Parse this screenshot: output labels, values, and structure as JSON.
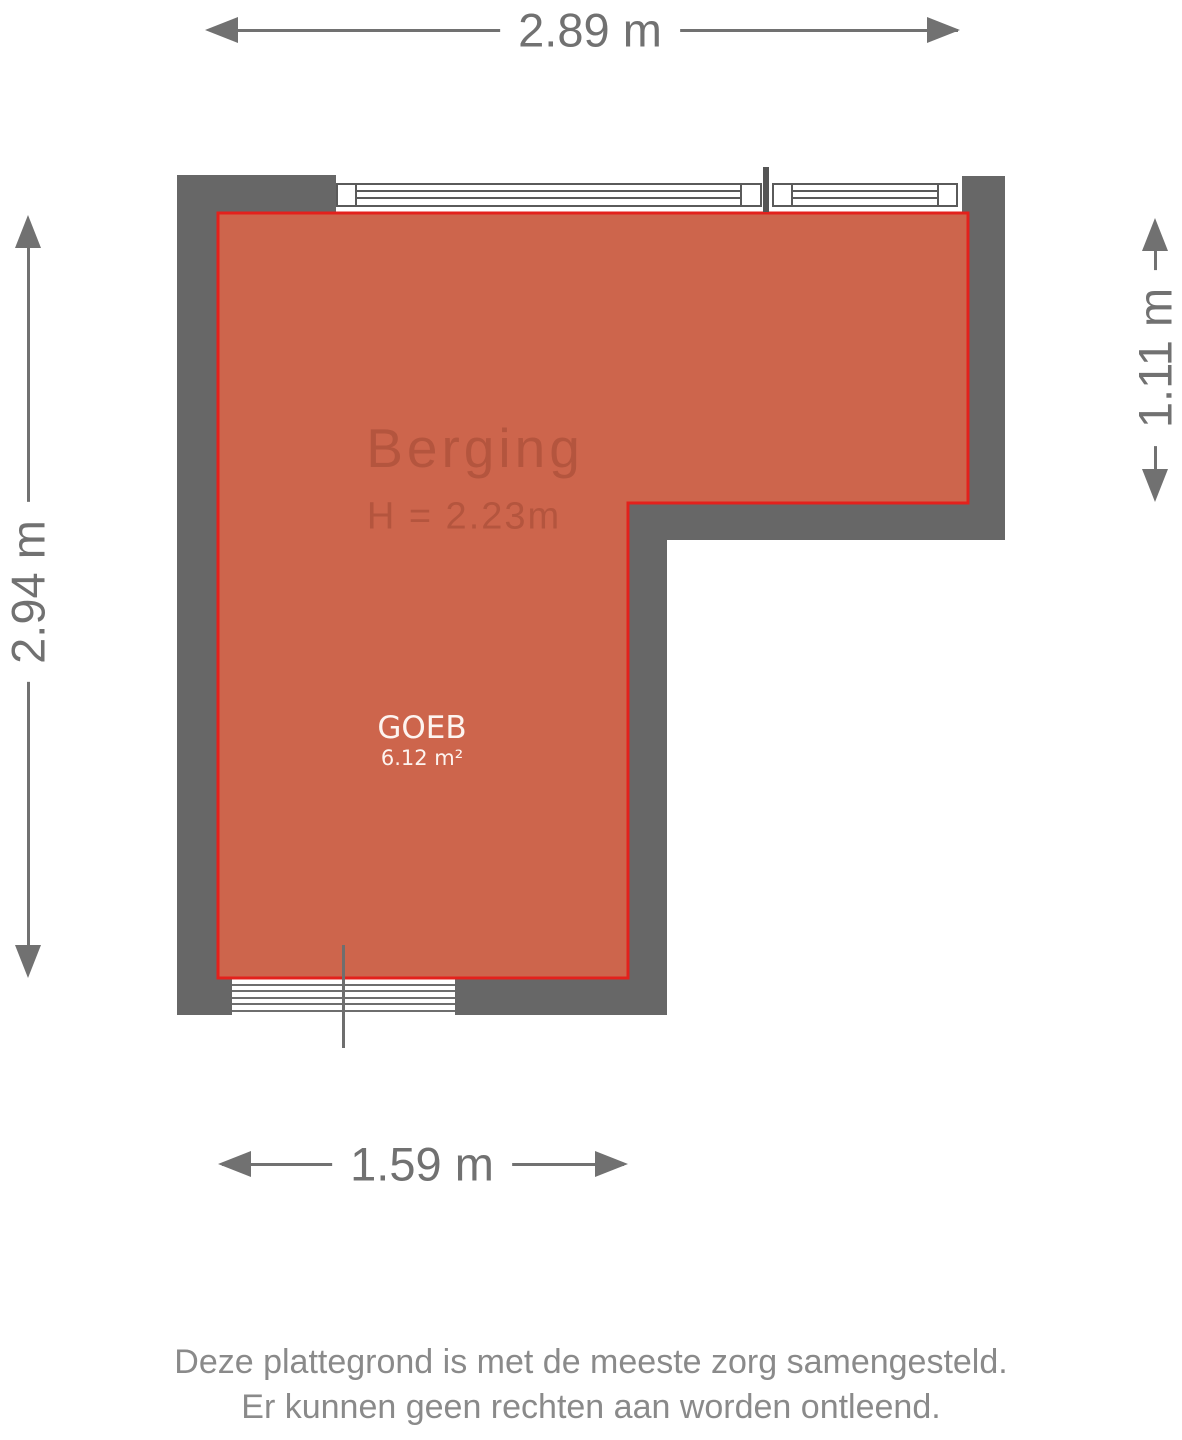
{
  "plan": {
    "room": {
      "name": "Berging",
      "height_label": "H = 2.23m",
      "code": "GOEB",
      "area_label": "6.12 m²"
    },
    "dimensions": {
      "top": "2.89 m",
      "left": "2.94 m",
      "right": "1.11 m",
      "bottom": "1.59 m"
    },
    "colors": {
      "wall": "#676767",
      "room_fill": "#cd654c",
      "room_border": "#e3211c",
      "room_label_text": "#b4553e",
      "room_code_text": "#fdf4f0",
      "dimension": "#717171",
      "window_line": "#5a5a5a",
      "window_mullion": "#555555",
      "door_line": "#6e6e6e",
      "footer_text": "#8a8a8a"
    }
  },
  "footer": {
    "line1": "Deze plattegrond is met de meeste zorg samengesteld.",
    "line2": "Er kunnen geen rechten aan worden ontleend."
  }
}
